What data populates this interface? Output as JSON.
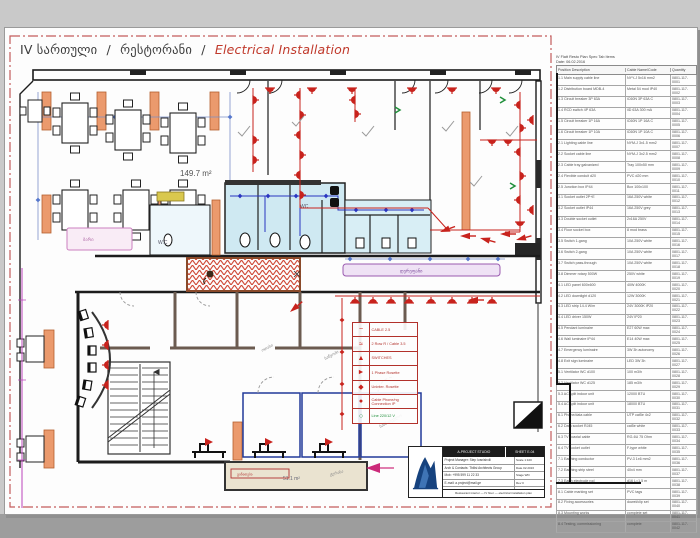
{
  "title": {
    "floor": "IV სართული",
    "sep1": "/",
    "room": "რესტორანი",
    "sep2": "/",
    "subject": "Electrical Installation"
  },
  "plan": {
    "area_main": "149.7 m²",
    "area_terrace": "51.1 m²",
    "wc_left": "W.C",
    "wc_right": "WC",
    "corridor_label": "დერეფანი",
    "bar_label": "ბარი",
    "terrace_label": "ტერასა",
    "terrace_tag": "განათება",
    "room_label_1": "ოთახი",
    "room_label_2": "საწყობი",
    "room_label_3": "სამზარეულო"
  },
  "colors": {
    "electric_red": "#c8231d",
    "legend_red": "#b2312b",
    "green_line": "#1f8f3a",
    "wc_cyan": "#cfe9f2",
    "column_orange": "#eb9a6d",
    "terrace_beige": "#eae3d0",
    "dim_blue": "#7b8fc7",
    "pipe_blue": "#2a35c0",
    "magenta": "#bb44bb",
    "logo_blue": "#16427e"
  },
  "legend": {
    "items": [
      {
        "name": "cable-squiggle-icon",
        "icon": "~",
        "label": "CABLE 2.5"
      },
      {
        "name": "double-socket-icon",
        "icon": "≈",
        "label": "2 Row R / Cable 3.5"
      },
      {
        "name": "switch-icon",
        "icon": "▲",
        "label": "SWITCHES"
      },
      {
        "name": "phase-rosette-icon",
        "icon": "►",
        "label": "1 Phase Rosette"
      },
      {
        "name": "uninterruptible-rosette-icon",
        "icon": "◆",
        "label": "Uninter. Rosette"
      },
      {
        "name": "phone-connection-icon",
        "icon": "●",
        "label": "Cable Phone/ng Connection IP"
      },
      {
        "name": "ground-line-icon",
        "icon": "○",
        "label": "Line 220/12 V"
      }
    ]
  },
  "spec_table": {
    "title_line1": "IV Flatt  Resto Plan  Spec Tab Items",
    "title_line2": "Date: 06.02.2016",
    "headers": [
      "Position Description",
      "Cable Name/Code",
      "Quantity"
    ],
    "rows": [
      {
        "d": "1.1 Main supply cable line",
        "n": "NYY-J 5x16 mm2",
        "q": "0801-117-0001"
      },
      {
        "d": "1.2 Distribution board MDB-4",
        "n": "Metal 54 mod IP40",
        "q": "0801-117-0002"
      },
      {
        "d": "1.3 Circuit breaker 3P 63A",
        "n": "iC60N 3P 63A C",
        "q": "0801-117-0003"
      },
      {
        "d": "1.4 RCD switch 4P 63A",
        "n": "iID 63A 300 mA",
        "q": "0801-117-0004"
      },
      {
        "d": "1.5 Circuit breaker 1P 16A",
        "n": "iC60N 1P 16A C",
        "q": "0801-117-0005"
      },
      {
        "d": "1.6 Circuit breaker 1P 10A",
        "n": "iC60N 1P 10A C",
        "q": "0801-117-0006"
      },
      {
        "d": "2.1 Lighting cable line",
        "n": "NYM-J 3x1.5 mm2",
        "q": "0801-117-0007"
      },
      {
        "d": "2.2 Socket cable line",
        "n": "NYM-J 3x2.5 mm2",
        "q": "0801-117-0008"
      },
      {
        "d": "2.3 Cable tray galvanized",
        "n": "Tray 100x50 mm",
        "q": "0801-117-0009"
      },
      {
        "d": "2.4 Flexible conduit d20",
        "n": "PVC d20 mm",
        "q": "0801-117-0010"
      },
      {
        "d": "2.5 Junction box IP44",
        "n": "Box 100x100",
        "q": "0801-117-0011"
      },
      {
        "d": "3.1 Socket outlet 2P+E",
        "n": "16A 250V white",
        "q": "0801-117-0012"
      },
      {
        "d": "3.2 Socket outlet IP44",
        "n": "16A 250V grey",
        "q": "0801-117-0013"
      },
      {
        "d": "3.3 Double socket outlet",
        "n": "2x16A 250V",
        "q": "0801-117-0014"
      },
      {
        "d": "3.4 Floor socket box",
        "n": "8 mod brass",
        "q": "0801-117-0015"
      },
      {
        "d": "3.5 Switch 1-gang",
        "n": "10A 250V white",
        "q": "0801-117-0016"
      },
      {
        "d": "3.6 Switch 2-gang",
        "n": "10A 250V white",
        "q": "0801-117-0017"
      },
      {
        "d": "3.7 Switch pass-through",
        "n": "10A 250V white",
        "q": "0801-117-0018"
      },
      {
        "d": "3.8 Dimmer rotary 500W",
        "n": "250V white",
        "q": "0801-117-0019"
      },
      {
        "d": "4.1 LED panel 600x600",
        "n": "40W 4000K",
        "q": "0801-117-0020"
      },
      {
        "d": "4.2 LED downlight d120",
        "n": "12W 3000K",
        "q": "0801-117-0021"
      },
      {
        "d": "4.3 LED strip 14.4 W/m",
        "n": "24V 3000K IP20",
        "q": "0801-117-0022"
      },
      {
        "d": "4.4 LED driver 150W",
        "n": "24V IP20",
        "q": "0801-117-0023"
      },
      {
        "d": "4.5 Pendant luminaire",
        "n": "E27 60W max",
        "q": "0801-117-0024"
      },
      {
        "d": "4.6 Wall luminaire IP44",
        "n": "E14 40W max",
        "q": "0801-117-0025"
      },
      {
        "d": "4.7 Emergency luminaire",
        "n": "3W 3h autonomy",
        "q": "0801-117-0026"
      },
      {
        "d": "4.8 Exit sign luminaire",
        "n": "LED 3W 3h",
        "q": "0801-117-0027"
      },
      {
        "d": "5.1 Ventilator WC d100",
        "n": "100 m3/h",
        "q": "0801-117-0028"
      },
      {
        "d": "5.2 Ventilator WC d125",
        "n": "185 m3/h",
        "q": "0801-117-0029"
      },
      {
        "d": "5.3 AC split indoor unit",
        "n": "12000 BTU",
        "q": "0801-117-0030"
      },
      {
        "d": "5.4 AC split indoor unit",
        "n": "18000 BTU",
        "q": "0801-117-0031"
      },
      {
        "d": "6.1 Phone/data cable",
        "n": "UTP cat5e 4x2",
        "q": "0801-117-0032"
      },
      {
        "d": "6.2 Data socket RJ45",
        "n": "cat5e white",
        "q": "0801-117-0033"
      },
      {
        "d": "6.3 TV coaxial cable",
        "n": "RG-6U 75 Ohm",
        "q": "0801-117-0034"
      },
      {
        "d": "6.4 TV socket outlet",
        "n": "F-type white",
        "q": "0801-117-0035"
      },
      {
        "d": "7.1 Earthing conductor",
        "n": "PV-3 1x6 mm2",
        "q": "0801-117-0036"
      },
      {
        "d": "7.2 Earthing strip steel",
        "n": "40x4 mm",
        "q": "0801-117-0037"
      },
      {
        "d": "7.3 Earth electrode rod",
        "n": "d16 L=1.5 m",
        "q": "0801-117-0038"
      },
      {
        "d": "8.1 Cable marking set",
        "n": "PVC tags",
        "q": "0801-117-0039"
      },
      {
        "d": "8.2 Fixing accessories",
        "n": "dowel/clip set",
        "q": "0801-117-0040"
      },
      {
        "d": "8.3 Mounting works",
        "n": "complete set",
        "q": "0801-117-0041"
      },
      {
        "d": "8.4 Testing, commissioning",
        "n": "complete",
        "q": "0801-117-0042"
      }
    ]
  },
  "title_block": {
    "company": "A-PROJECT STUDIO",
    "sheet": "SHEET E-04",
    "rows": [
      "Project Manager:  Step Ivanishvili",
      "Arch & Contacts:  Tbilisi Architects Group",
      "Mob:  +995 599 11 22 33",
      "E-mail:  a.project@mail.ge"
    ],
    "right": [
      "Scale 1:100",
      "Date 02.2016",
      "Stage WD",
      "Rev 0"
    ],
    "footer": "Restaurant interior — IV floor — electrical installation plan"
  }
}
